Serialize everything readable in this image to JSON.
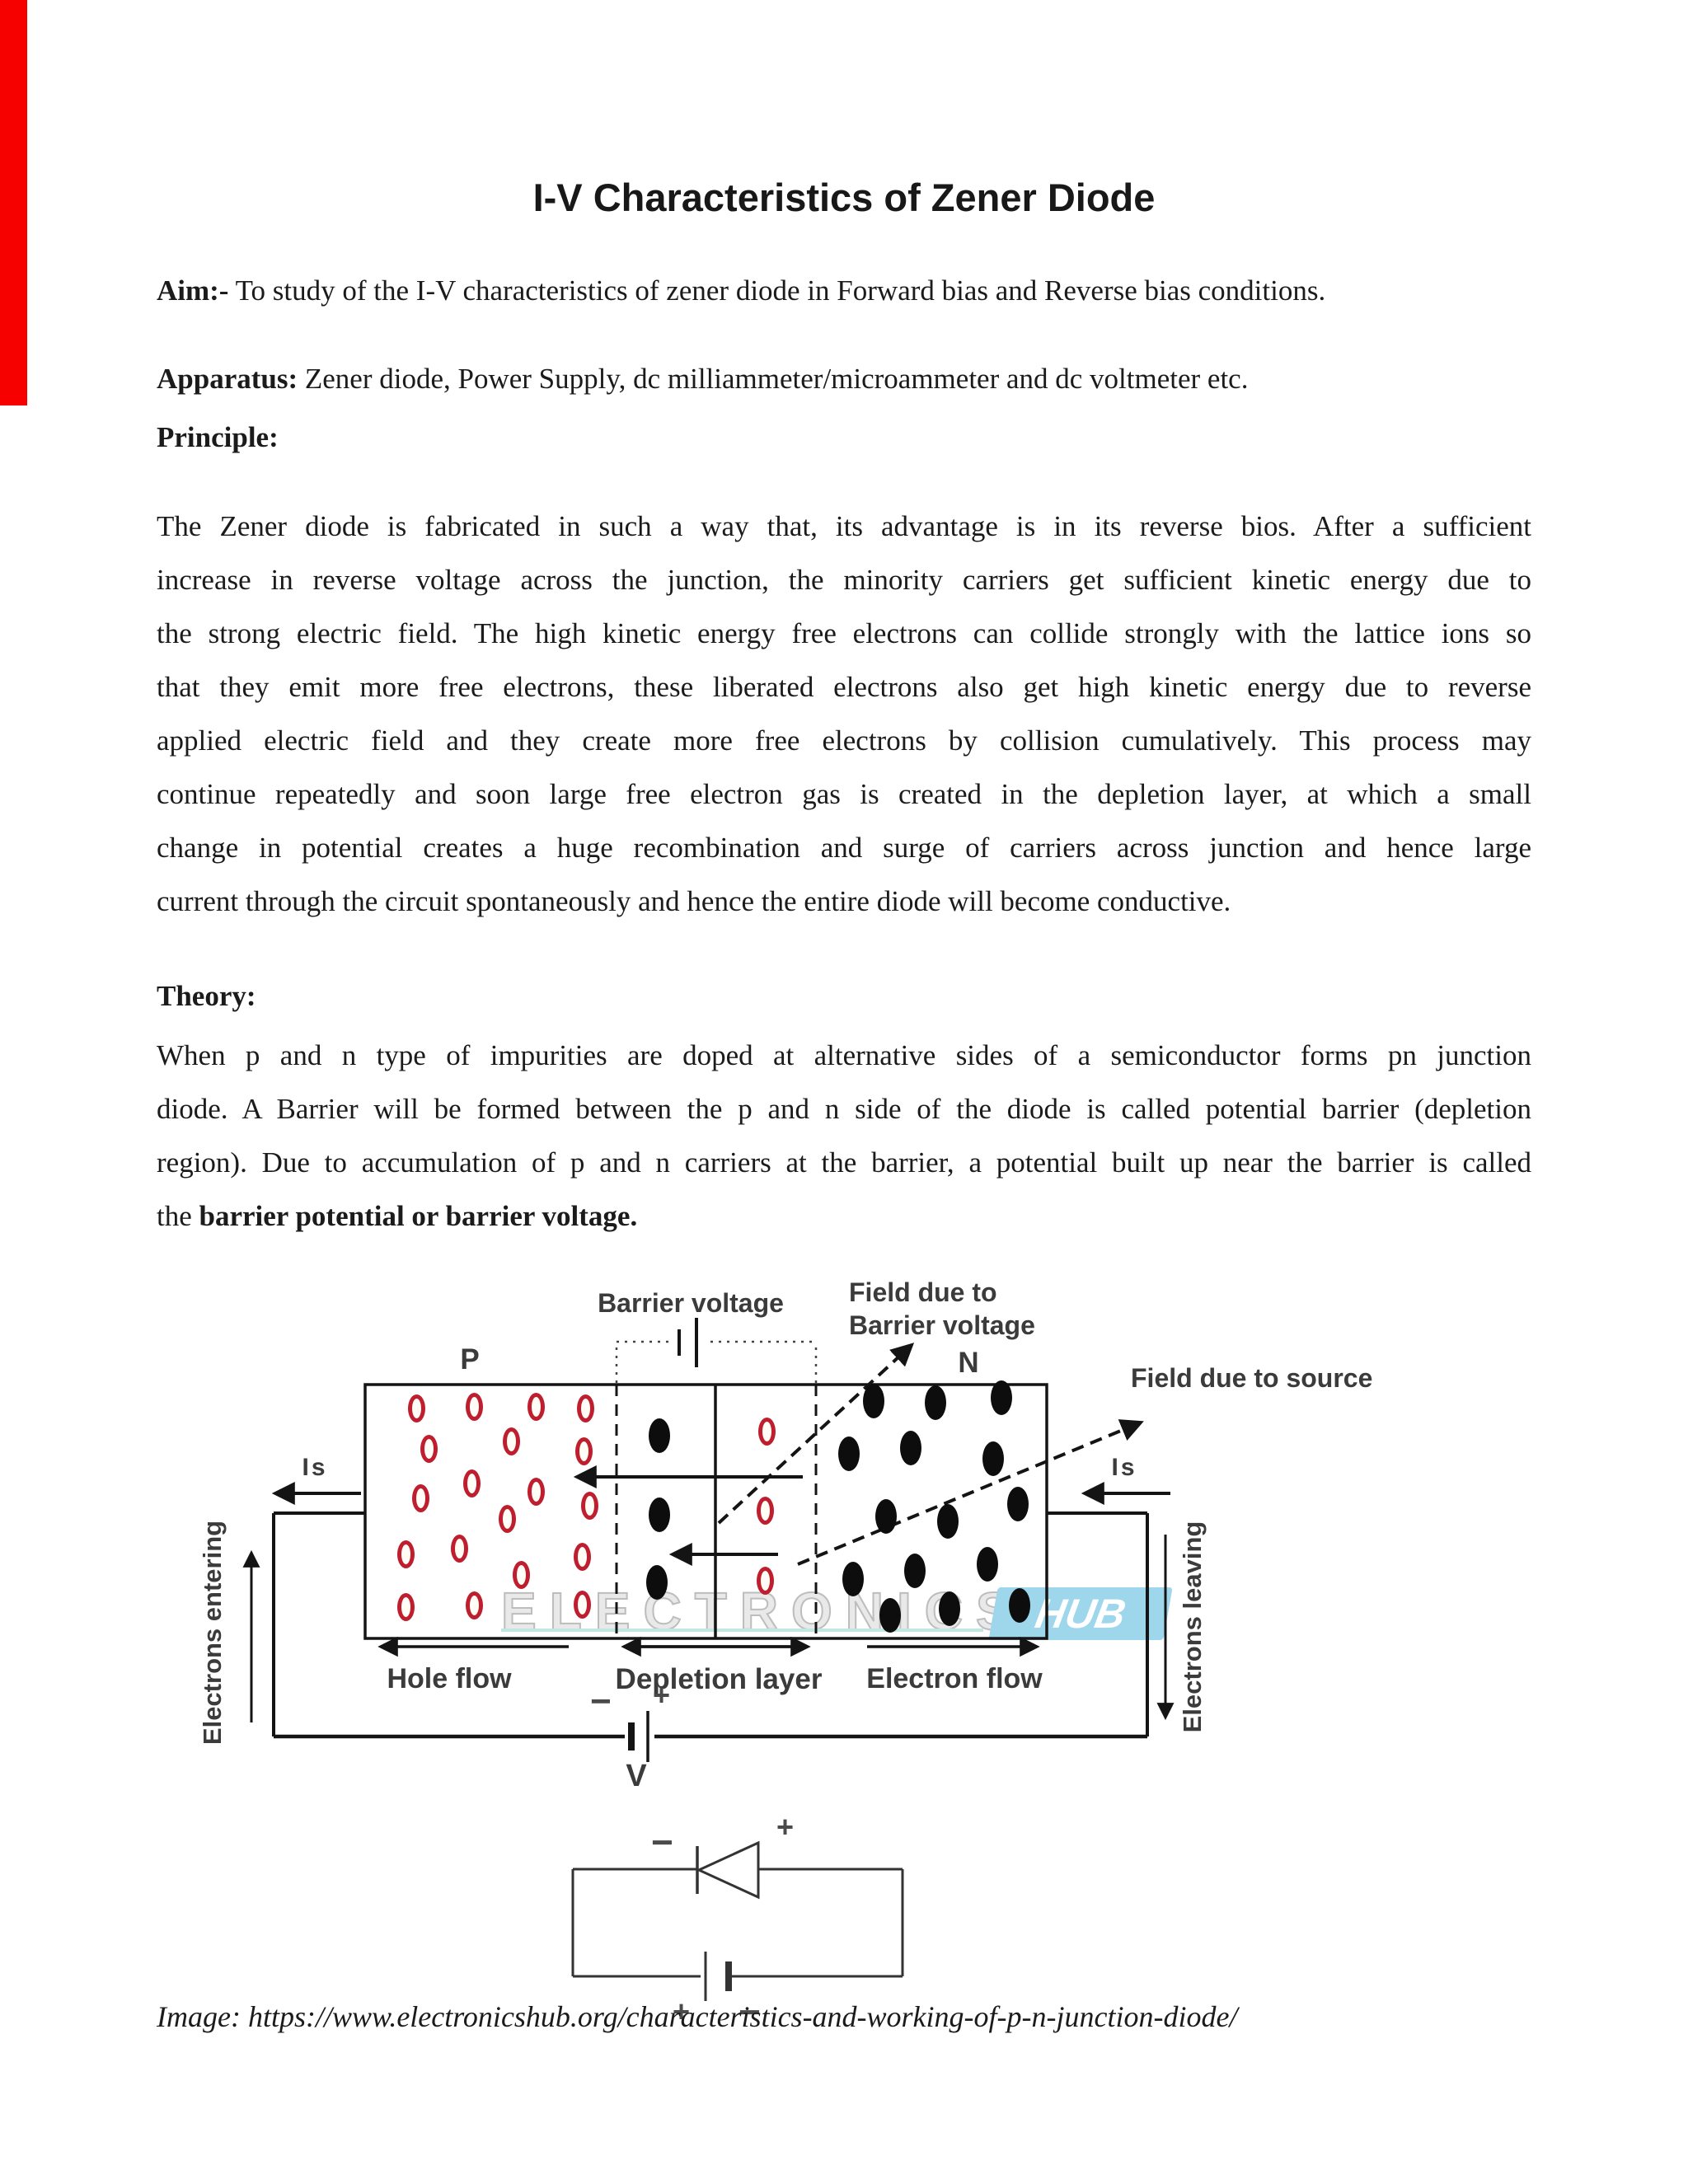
{
  "title": "I-V Characteristics of Zener Diode",
  "aim": {
    "label": "Aim:-",
    "text": "To study of the I-V characteristics of zener diode in Forward bias and Reverse bias conditions."
  },
  "apparatus": {
    "label": "Apparatus:",
    "text": "Zener diode, Power Supply, dc milliammeter/microammeter and dc voltmeter etc."
  },
  "principle": {
    "label": "Principle:",
    "lines": [
      "The Zener diode is fabricated in such a way that, its advantage is in its reverse bios. After a sufficient",
      "increase in reverse voltage across the junction, the minority carriers get sufficient kinetic energy due to",
      "the strong electric field. The high kinetic energy free electrons can collide strongly with the lattice ions so",
      "that they emit more free electrons, these liberated electrons also get high kinetic energy due to reverse",
      "applied electric field and they create more free electrons by collision cumulatively. This process may",
      "continue repeatedly and soon large free electron gas is created in the depletion layer, at which a small",
      "change in potential creates a huge recombination and surge of carriers across junction and hence large",
      "current through the circuit spontaneously and hence the entire diode will become conductive."
    ]
  },
  "theory": {
    "label": "Theory:",
    "lines": [
      "When p and n type of impurities are doped at alternative sides of a semiconductor forms pn junction",
      "diode. A Barrier will be formed between the p and n side of the diode is called potential barrier (depletion",
      "region). Due to accumulation of p and n carriers at the barrier, a potential built up near the barrier is called"
    ],
    "last_prefix": "the ",
    "last_bold": "barrier potential or barrier voltage."
  },
  "diagram": {
    "labels": {
      "barrier_voltage": "Barrier voltage",
      "field_barrier_line1": "Field due to",
      "field_barrier_line2": "Barrier voltage",
      "field_source": "Field due to source",
      "p": "P",
      "n": "N",
      "is": "Is",
      "hole_flow": "Hole flow",
      "depletion_layer": "Depletion layer",
      "electron_flow": "Electron flow",
      "electrons_entering": "Electrons entering",
      "electrons_leaving": "Electrons leaving",
      "v": "V",
      "plus": "+",
      "minus": "−"
    },
    "watermark": {
      "text": "ELECTRONICS",
      "hub": "HUB",
      "hub_bg": "#9ed6ec"
    },
    "colors": {
      "hole_ring": "#bf1e2e",
      "electron": "#0d0d0d",
      "red_bar": "#f60000"
    },
    "holes": [
      [
        505,
        1709
      ],
      [
        575,
        1707
      ],
      [
        650,
        1707
      ],
      [
        710,
        1709
      ],
      [
        520,
        1758
      ],
      [
        620,
        1749
      ],
      [
        708,
        1761
      ],
      [
        510,
        1818
      ],
      [
        572,
        1800
      ],
      [
        650,
        1810
      ],
      [
        715,
        1827
      ],
      [
        615,
        1843
      ],
      [
        492,
        1886
      ],
      [
        557,
        1879
      ],
      [
        706,
        1889
      ],
      [
        632,
        1911
      ],
      [
        492,
        1950
      ],
      [
        575,
        1948
      ],
      [
        706,
        1947
      ],
      [
        930,
        1737
      ],
      [
        928,
        1833
      ],
      [
        928,
        1918
      ]
    ],
    "electrons": [
      [
        800,
        1742
      ],
      [
        800,
        1838
      ],
      [
        797,
        1920
      ],
      [
        1060,
        1700
      ],
      [
        1135,
        1702
      ],
      [
        1215,
        1696
      ],
      [
        1030,
        1764
      ],
      [
        1105,
        1757
      ],
      [
        1205,
        1770
      ],
      [
        1075,
        1840
      ],
      [
        1150,
        1846
      ],
      [
        1235,
        1825
      ],
      [
        1035,
        1916
      ],
      [
        1110,
        1906
      ],
      [
        1198,
        1898
      ],
      [
        1080,
        1960
      ],
      [
        1152,
        1952
      ],
      [
        1237,
        1948
      ]
    ]
  },
  "circuit2": {
    "plus_top": "+",
    "minus_top": "−",
    "plus_bottom": "+",
    "minus_bottom": "−"
  },
  "credit": "Image: https://www.electronicshub.org/characteristics-and-working-of-p-n-junction-diode/"
}
